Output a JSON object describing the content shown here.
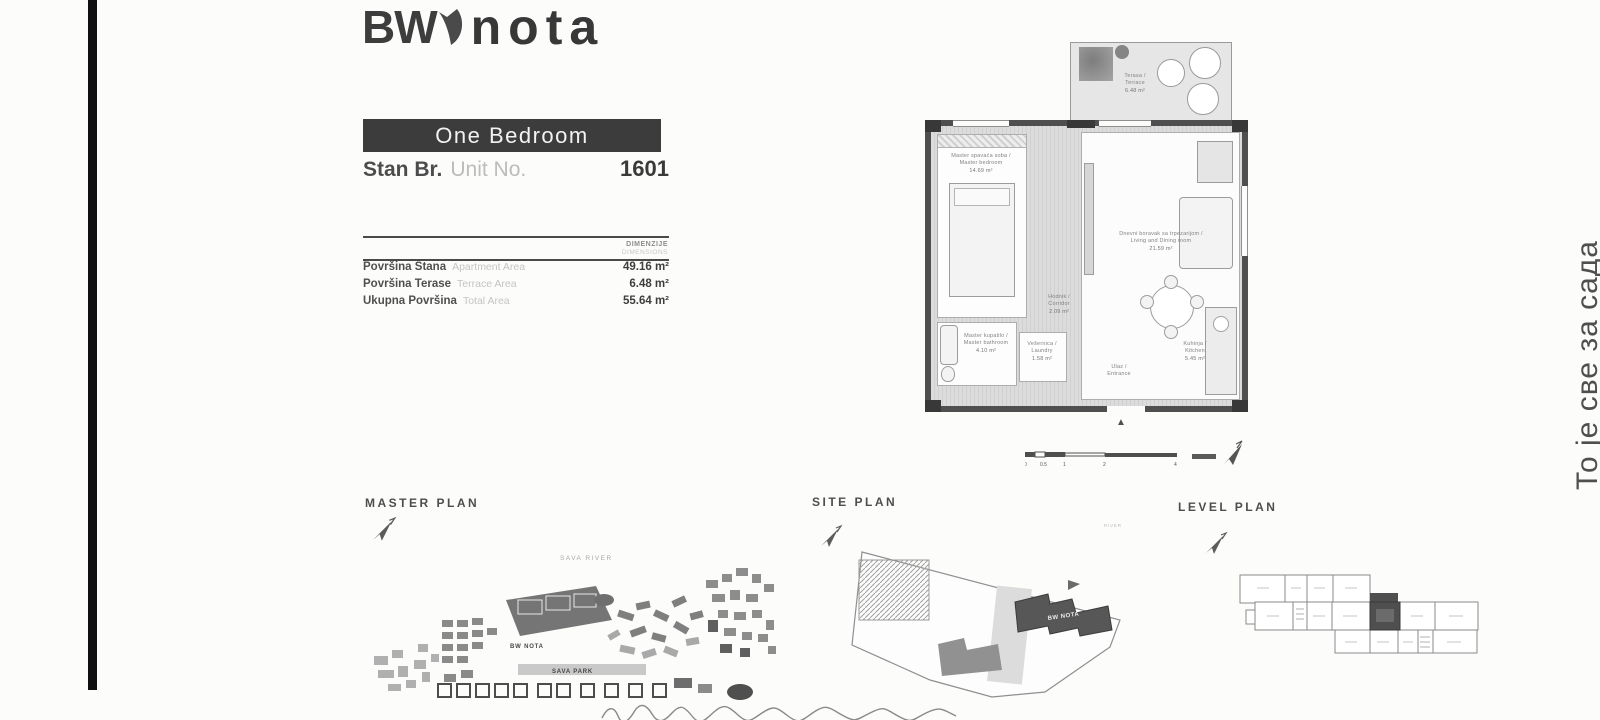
{
  "logo": {
    "bw": "BW",
    "nota": "nota"
  },
  "unit_header": {
    "type": "One Bedroom",
    "stan_label": "Stan Br.",
    "unit_label": "Unit No.",
    "number": "1601"
  },
  "dimensions": {
    "header_sr": "DIMENZIJE",
    "header_en": "DIMENSIONS",
    "rows": [
      {
        "sr": "Površina Stana",
        "en": "Apartment Area",
        "value": "49.16 m²"
      },
      {
        "sr": "Površina Terase",
        "en": "Terrace Area",
        "value": "6.48 m²"
      },
      {
        "sr": "Ukupna Površina",
        "en": "Total Area",
        "value": "55.64 m²"
      }
    ]
  },
  "floor_plan": {
    "rooms": {
      "terrace": {
        "sr": "Terasa",
        "en": "Terrace",
        "area": "6.48 m²"
      },
      "bedroom": {
        "sr": "Master spavaća soba",
        "en": "Master bedroom",
        "area": "14.69 m²"
      },
      "living": {
        "sr": "Dnevni boravak sa trpezarijom",
        "en": "Living and Dining room",
        "area": "21.59 m²"
      },
      "corridor": {
        "sr": "Hodnik",
        "en": "Corridor",
        "area": "2.09 m²"
      },
      "laundry": {
        "sr": "Vešernica",
        "en": "Laundry",
        "area": "1.58 m²"
      },
      "bathroom": {
        "sr": "Master kupatilo",
        "en": "Master bathroom",
        "area": "4.10 m²"
      },
      "kitchen": {
        "sr": "Kuhinja",
        "en": "Kitchen",
        "area": "5.45 m²"
      },
      "entrance": {
        "sr": "Ulaz",
        "en": "Entrance",
        "area": ""
      }
    },
    "scale": {
      "ticks": [
        "0",
        "0.5",
        "1",
        "2",
        "4"
      ]
    }
  },
  "plans": {
    "master": {
      "title": "MASTER PLAN",
      "river": "SAVA RIVER",
      "park": "SAVA PARK",
      "building": "BW NOTA"
    },
    "site": {
      "title": "SITE PLAN",
      "building": "BW NOTA",
      "river": "RIVER"
    },
    "level": {
      "title": "LEVEL PLAN"
    }
  },
  "side_note": {
    "text": "То је све за сада"
  },
  "colors": {
    "banner": "#3c3c3c",
    "wall": "#4f4f4f",
    "highlight_unit": "#4f4f4f"
  }
}
